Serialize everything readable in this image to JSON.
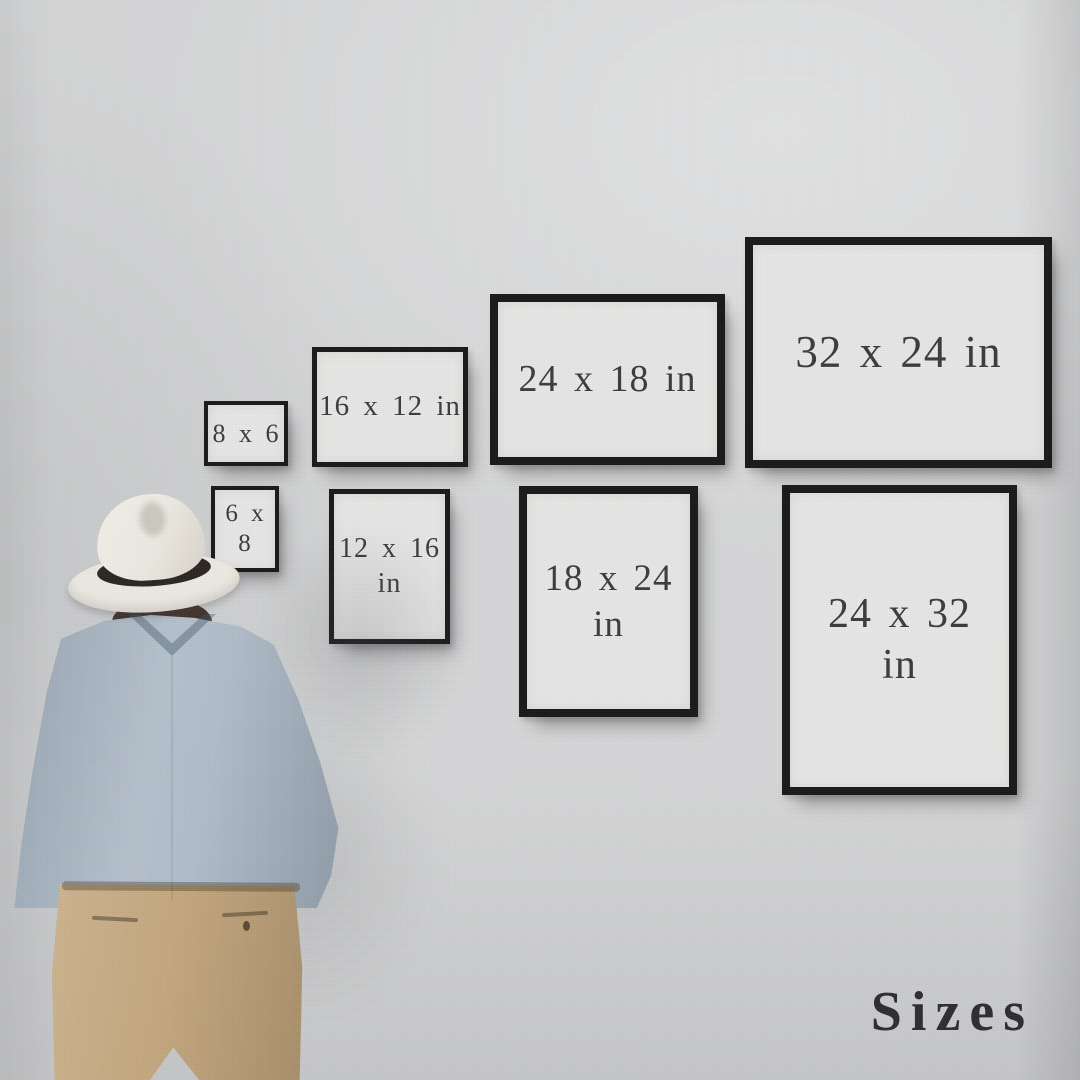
{
  "scene": {
    "title_label": "Sizes",
    "colors": {
      "wall": "#d6d7d8",
      "frame_border": "#19191a",
      "frame_paper": "#e7e7e6",
      "frame_label": "#3c3c3c",
      "title": "#2d2d32"
    }
  },
  "figure": {
    "pose": "man seen from behind looking at wall of frames",
    "colors": {
      "hat": "#edeae2",
      "hat_band": "#2b2620",
      "hair": "#43342d",
      "shirt": "#a7b5c3",
      "trousers": "#c3a67c"
    }
  },
  "frames": [
    {
      "size_label": "8 x 6",
      "lines": [
        "8 x 6"
      ],
      "orientation": "landscape",
      "x": 204,
      "y": 401,
      "w": 84,
      "h": 65,
      "font_px": 26
    },
    {
      "size_label": "16 x 12 in",
      "lines": [
        "16 x 12 in"
      ],
      "orientation": "landscape",
      "x": 312,
      "y": 347,
      "w": 156,
      "h": 120,
      "font_px": 29
    },
    {
      "size_label": "24 x 18 in",
      "lines": [
        "24 x 18 in"
      ],
      "orientation": "landscape",
      "x": 490,
      "y": 294,
      "w": 235,
      "h": 171,
      "font_px": 38
    },
    {
      "size_label": "32 x 24 in",
      "lines": [
        "32 x 24 in"
      ],
      "orientation": "landscape",
      "x": 745,
      "y": 237,
      "w": 307,
      "h": 231,
      "font_px": 45
    },
    {
      "size_label": "6 x 8",
      "lines": [
        "6 x 8"
      ],
      "orientation": "portrait",
      "x": 211,
      "y": 486,
      "w": 68,
      "h": 86,
      "font_px": 25
    },
    {
      "size_label": "12 x 16 in",
      "lines": [
        "12 x 16",
        "in"
      ],
      "orientation": "portrait",
      "x": 329,
      "y": 489,
      "w": 121,
      "h": 155,
      "font_px": 28
    },
    {
      "size_label": "18 x 24 in",
      "lines": [
        "18 x 24",
        "in"
      ],
      "orientation": "portrait",
      "x": 519,
      "y": 486,
      "w": 179,
      "h": 231,
      "font_px": 37
    },
    {
      "size_label": "24 x 32 in",
      "lines": [
        "24 x 32",
        "in"
      ],
      "orientation": "portrait",
      "x": 782,
      "y": 485,
      "w": 235,
      "h": 310,
      "font_px": 42
    }
  ]
}
